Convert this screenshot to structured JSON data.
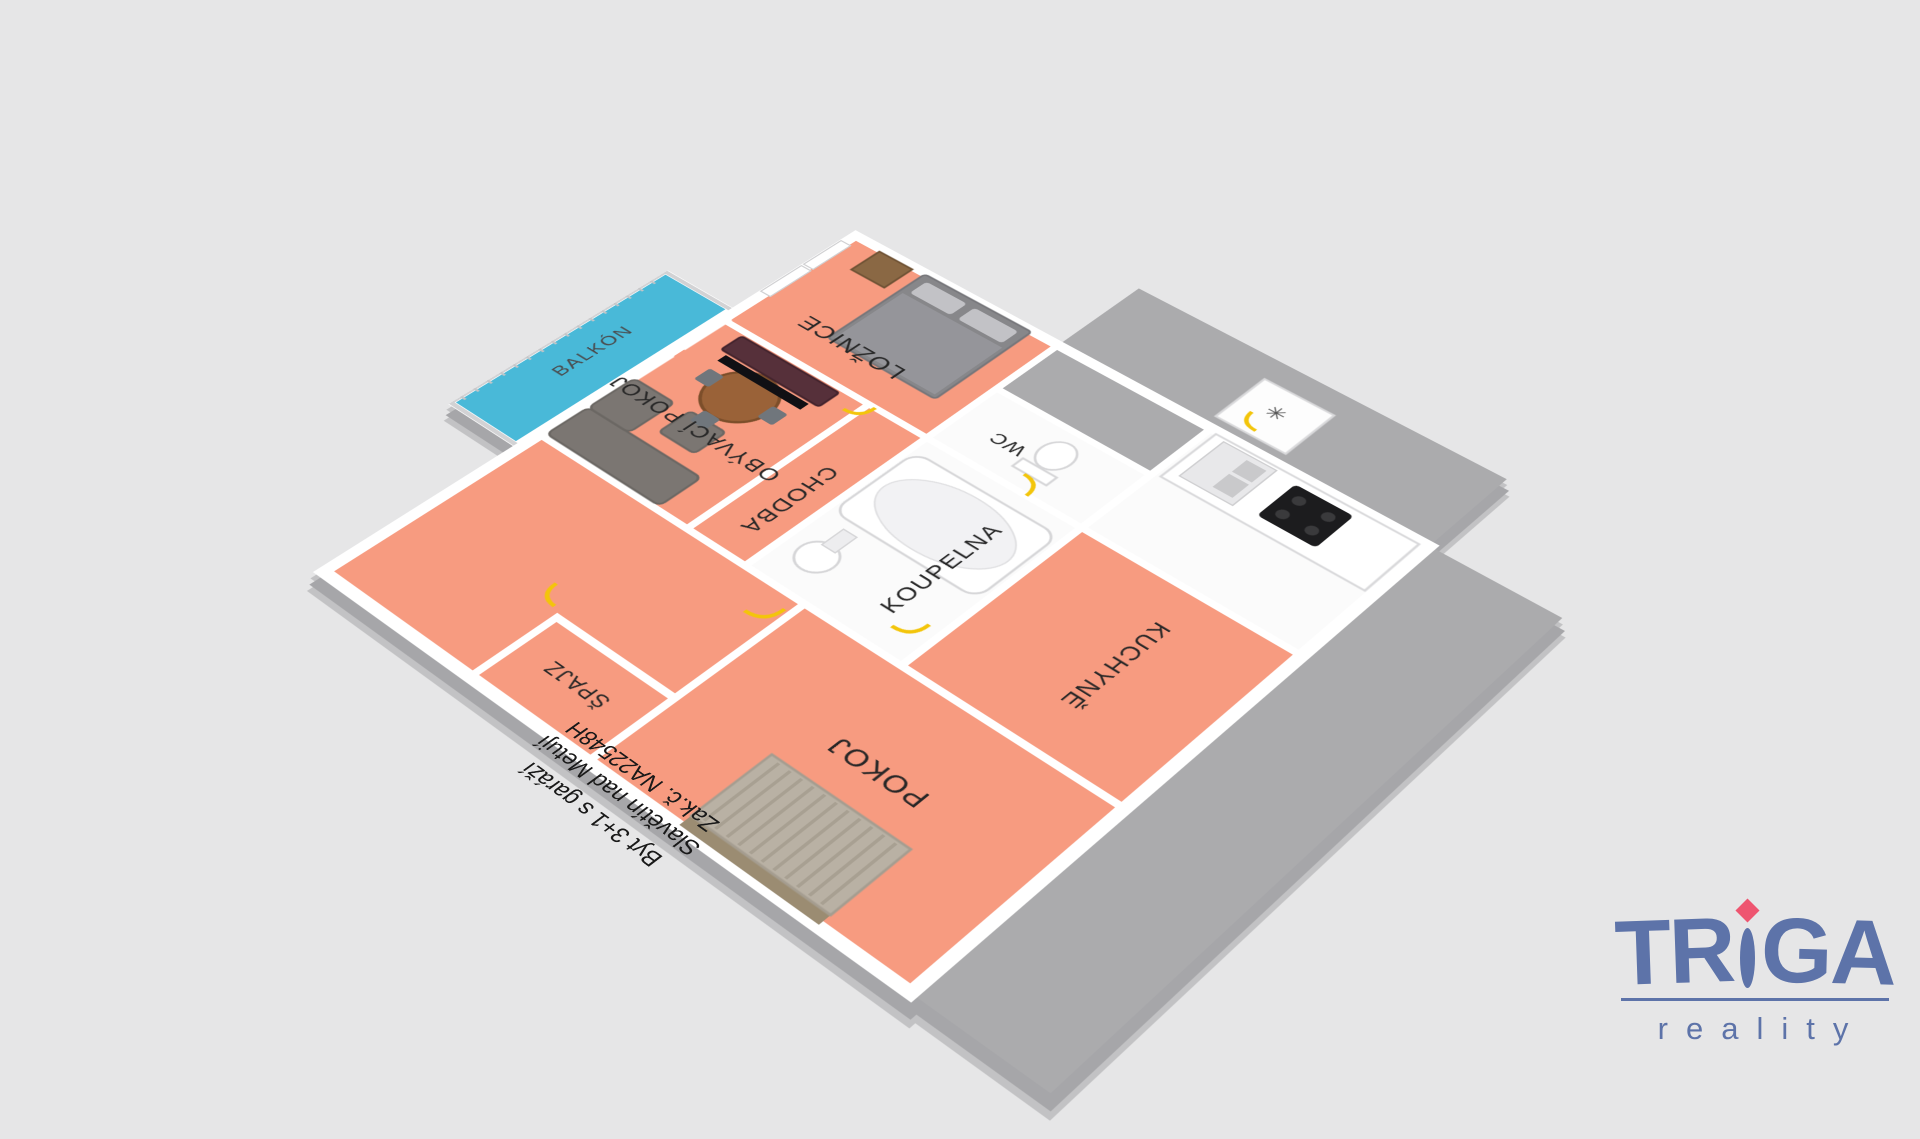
{
  "scene": {
    "background": "#e6e6e7",
    "floor_color": "#f79b80",
    "balcony_floor_color": "#49b9d8",
    "wall_color": "#ffffff",
    "wall_shadow_color": "#a6a6a9",
    "exterior_floor_color": "#ababad",
    "door_marker_color": "#f3c50a"
  },
  "rooms": {
    "loznice": "LOŽNICE",
    "obyvaci_pokoj": "OBÝVACÍ POKOJ",
    "chodba": "CHODBA",
    "koupelna": "KOUPELNA",
    "wc": "WC",
    "kuchyne": "KUCHYNĚ",
    "pokoj": "POKOJ",
    "spajz": "ŠPAJZ",
    "balkon": "BALKÓN"
  },
  "kitchen": {
    "freezer_symbol": "✳"
  },
  "annotation": {
    "line1": "Byt 3+1 s garáží",
    "line2": "Slavětín nad Metují",
    "line3": "Zak.č. NA22548H"
  },
  "logo": {
    "brand_prefix": "TR",
    "brand_suffix": "GA",
    "subtitle": "reality",
    "brand_color": "#5d73a9",
    "diamond_color": "#ee5570"
  }
}
